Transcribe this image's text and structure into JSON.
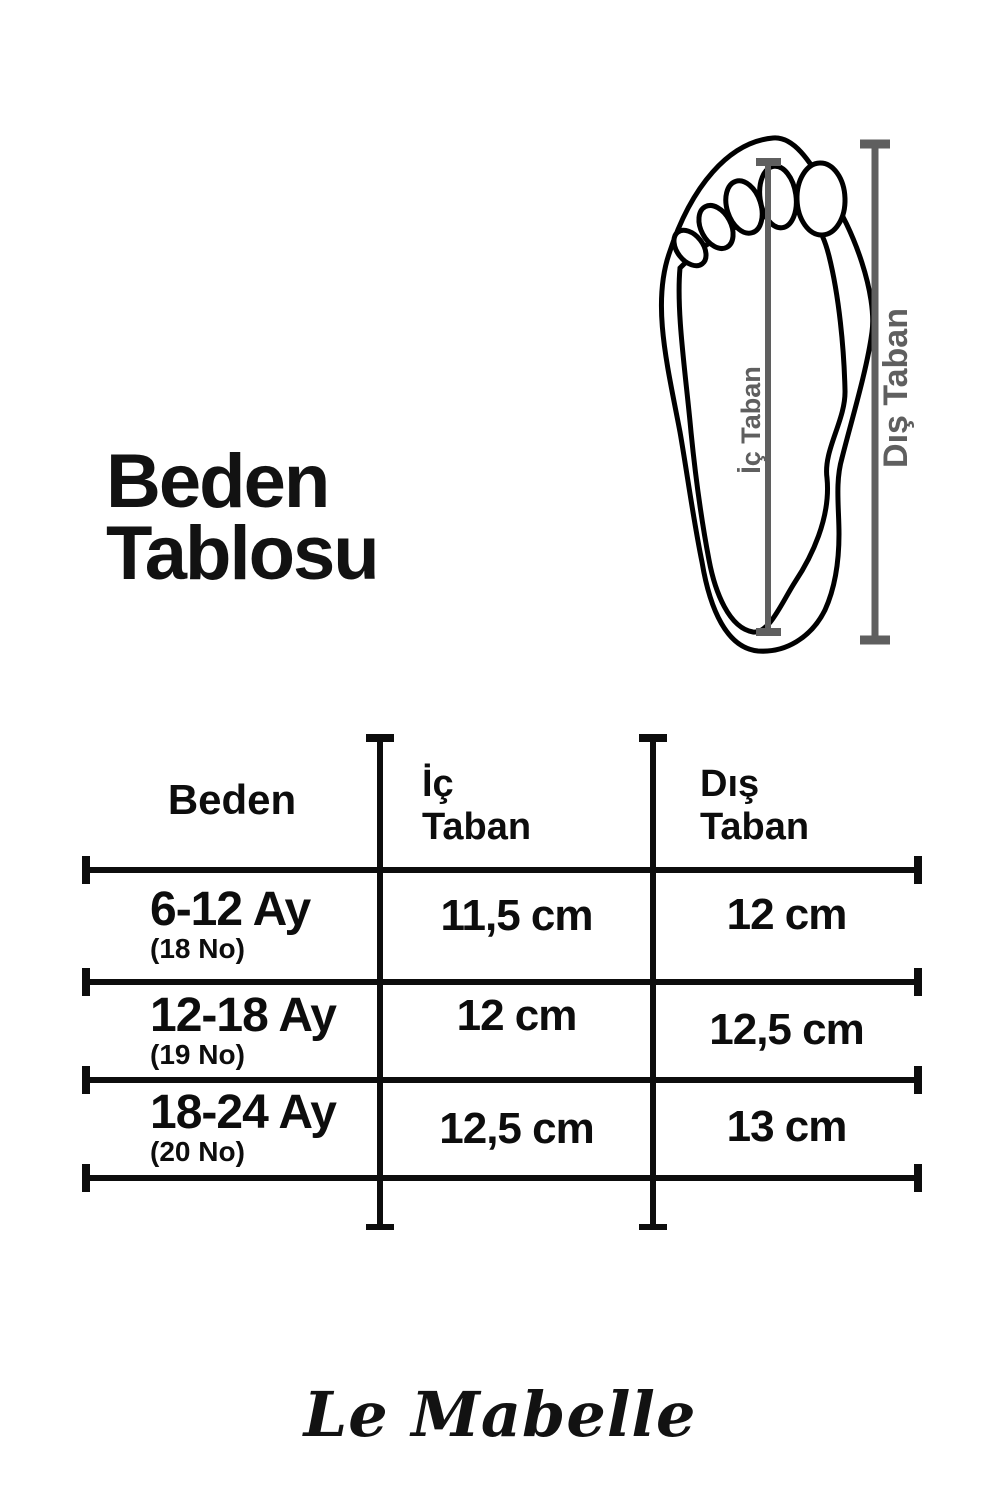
{
  "title": {
    "line1": "Beden",
    "line2": "Tablosu"
  },
  "diagram": {
    "inner_label": "İç Taban",
    "outer_label": "Dış Taban"
  },
  "table": {
    "headers": [
      {
        "label": "Beden"
      },
      {
        "label": "İç Taban",
        "line1": "İç",
        "line2": "Taban"
      },
      {
        "label": "Dış Taban",
        "line1": "Dış",
        "line2": "Taban"
      }
    ],
    "rows": [
      {
        "size": "6-12 Ay",
        "number": "(18 No)",
        "ic_taban": "11,5 cm",
        "dis_taban": "12 cm"
      },
      {
        "size": "12-18 Ay",
        "number": "(19 No)",
        "ic_taban": "12 cm",
        "dis_taban": "12,5 cm"
      },
      {
        "size": "18-24 Ay",
        "number": "(20 No)",
        "ic_taban": "12,5 cm",
        "dis_taban": "13 cm"
      }
    ]
  },
  "footer": {
    "brand": "Le Mabelle"
  },
  "colors": {
    "text": "#0d0d0d",
    "outline": "#000000",
    "measure": "#5f5f5f"
  },
  "chart_data": {
    "type": "table",
    "title": "Beden Tablosu",
    "columns": [
      "Beden",
      "İç Taban",
      "Dış Taban"
    ],
    "rows": [
      [
        "6-12 Ay (18 No)",
        "11,5 cm",
        "12 cm"
      ],
      [
        "12-18 Ay (19 No)",
        "12 cm",
        "12,5 cm"
      ],
      [
        "18-24 Ay (20 No)",
        "12,5 cm",
        "13 cm"
      ]
    ]
  }
}
